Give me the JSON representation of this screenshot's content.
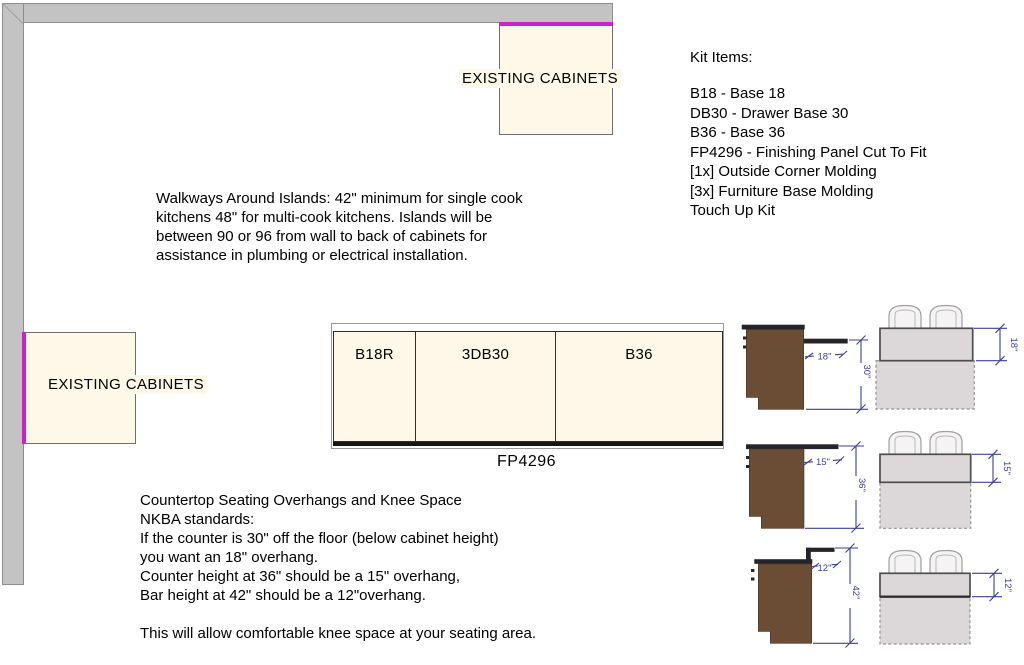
{
  "colors": {
    "wall_gray": "#c3c3c3",
    "cabinet_cream": "#fdf8e7",
    "attach_magenta": "#cc22cc",
    "cabinet_brown": "#6b4c35",
    "counter_dark": "#24242b",
    "dimension_purple": "#3e3e99"
  },
  "plan": {
    "top_cabinet_label": "EXISTING CABINETS",
    "left_cabinet_label": "EXISTING CABINETS",
    "island": {
      "cabinets": [
        "B18R",
        "3DB30",
        "B36"
      ],
      "panel_label": "FP4296"
    }
  },
  "kit": {
    "title": "Kit Items:",
    "items": [
      "B18 - Base 18",
      "DB30 - Drawer Base 30",
      "B36 - Base 36",
      "FP4296 - Finishing Panel Cut To Fit",
      "[1x] Outside Corner Molding",
      "[3x] Furniture Base Molding",
      "Touch Up Kit"
    ]
  },
  "walkways": {
    "lines": [
      "Walkways Around Islands: 42\" minimum for single cook",
      "kitchens 48\" for multi-cook kitchens. Islands will be",
      "between 90 or 96 from wall to back of cabinets for",
      "assistance in plumbing or electrical installation."
    ]
  },
  "seating": {
    "lines": [
      "Countertop Seating Overhangs and Knee Space",
      "NKBA standards:",
      "If the counter is 30\" off the floor (below cabinet height)",
      "you want an 18\" overhang.",
      "Counter height at 36\" should be a 15\" overhang,",
      "Bar height at 42\" should be a 12\"overhang."
    ],
    "footer": "This will allow comfortable knee space at your seating area."
  },
  "sections": [
    {
      "overhang": "18\"",
      "height": "30\""
    },
    {
      "overhang": "15\"",
      "height": "36\""
    },
    {
      "overhang": "12\"",
      "height": "42\""
    }
  ]
}
